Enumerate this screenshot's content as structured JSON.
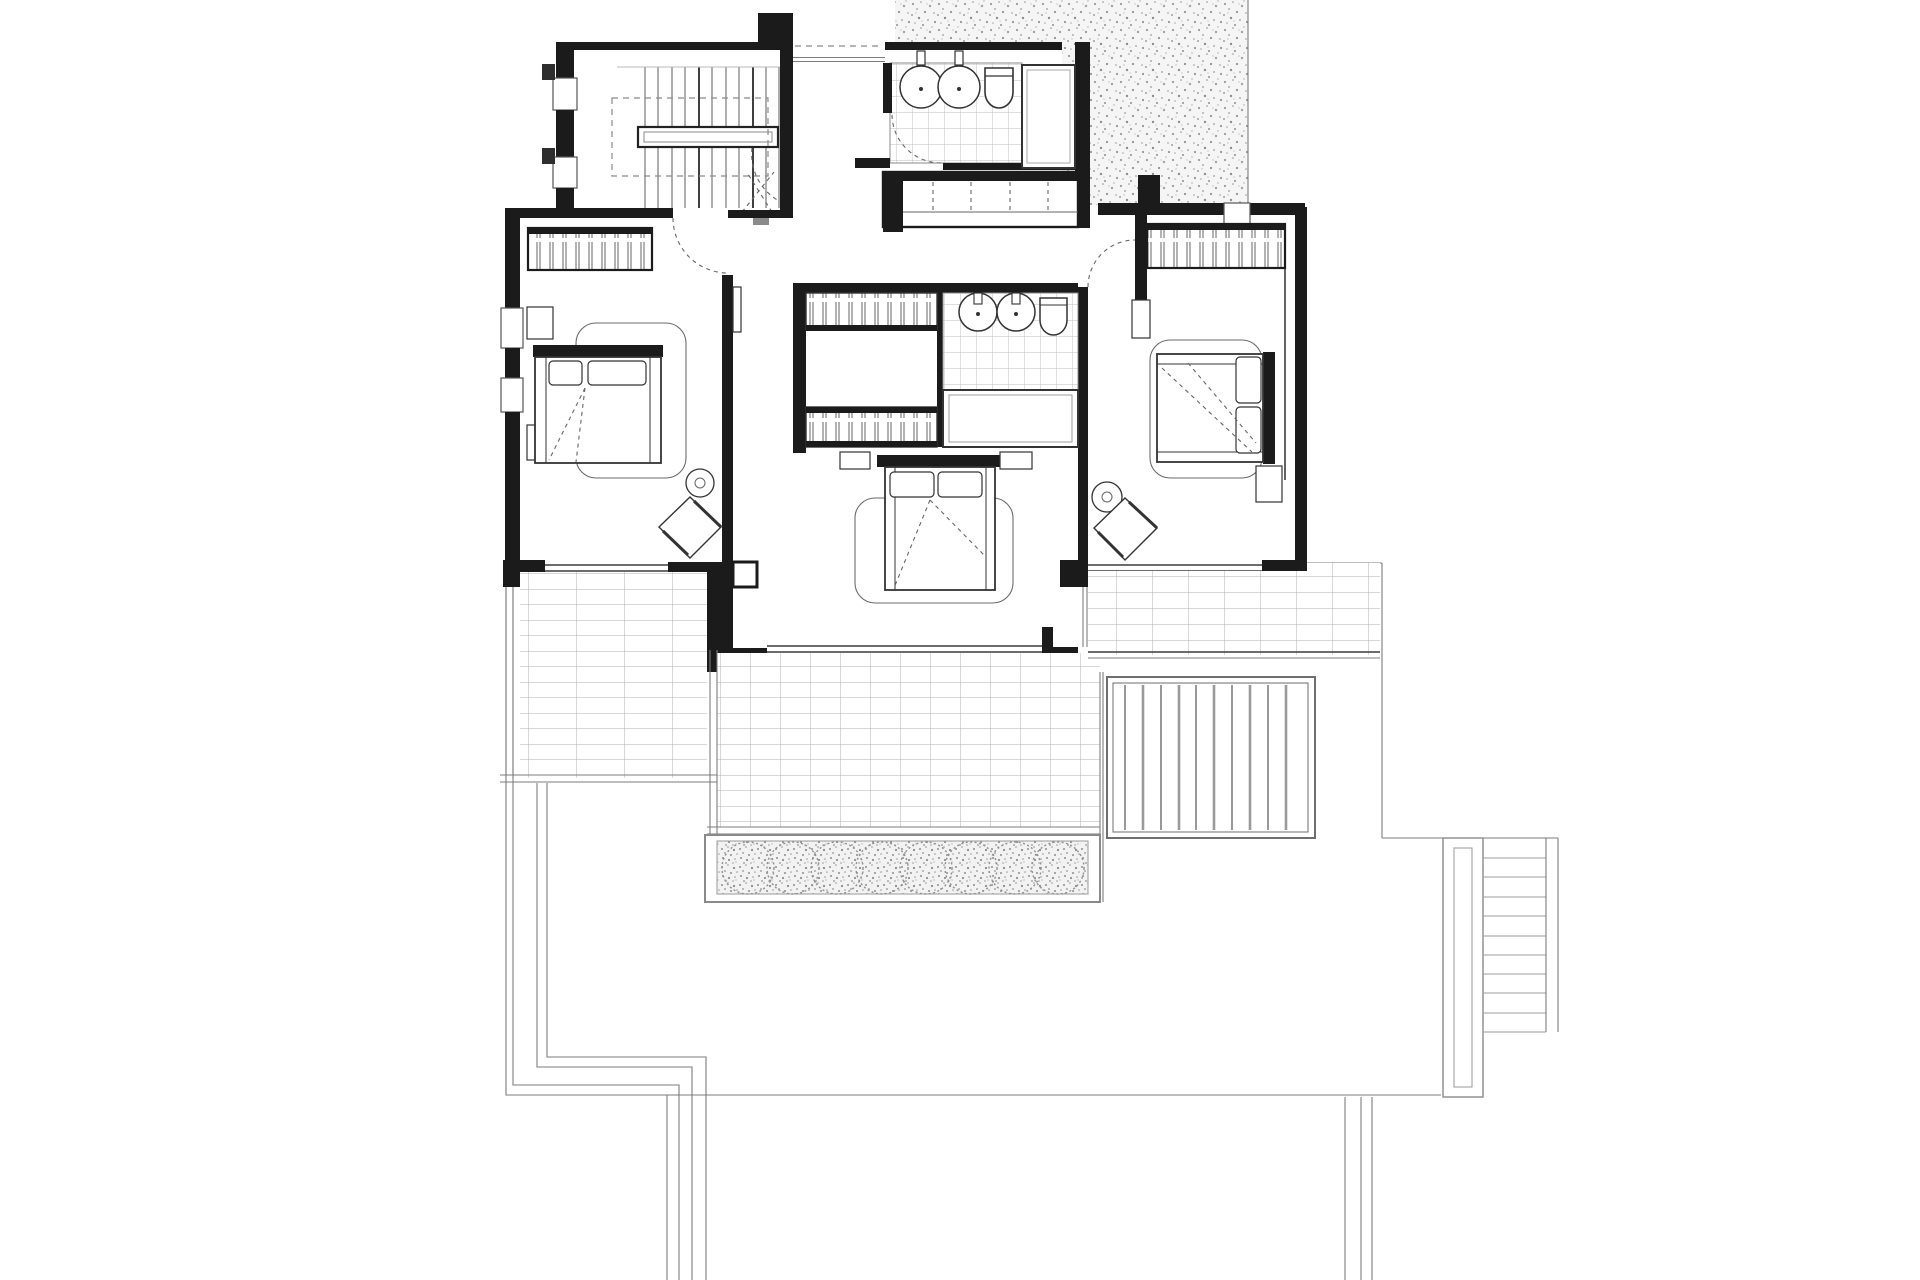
{
  "document": {
    "type": "architectural-floor-plan",
    "view": "upper floor plan, top-down CAD line drawing",
    "has_text": false,
    "background": "#ffffff"
  },
  "palette": {
    "paper": "#ffffff",
    "wall_ink": "#1b1b1b",
    "strong_line": "#3c3c3c",
    "mid_line": "#7d7d7d",
    "light_line": "#b9b9b9",
    "dashed_line": "#8a8a8a",
    "stipple": "#9a9a9a"
  },
  "rooms": [
    {
      "id": "stair-room",
      "kind": "interior staircase with handrail and open void (dashed)"
    },
    {
      "id": "bathroom-top",
      "kind": "bathroom: 2 round basins, toilet, shower, tiled floor"
    },
    {
      "id": "hall-closet",
      "kind": "open closet with dashed shelf divisions"
    },
    {
      "id": "hallway",
      "kind": "landing/hallway with three door swings"
    },
    {
      "id": "bedroom-left",
      "kind": "bedroom: wardrobe, double bed, side table, armchair"
    },
    {
      "id": "dressing",
      "kind": "dressing area with two hatched closet runs"
    },
    {
      "id": "bathroom-ensuite",
      "kind": "ensuite: 2 basins, toilet, bathtub, tiled floor"
    },
    {
      "id": "bedroom-center",
      "kind": "bedroom: double bed with two nightstands"
    },
    {
      "id": "bedroom-right",
      "kind": "bedroom: wardrobe, double bed, side table, armchair"
    },
    {
      "id": "terrace-left",
      "kind": "plank-tiled terrace"
    },
    {
      "id": "terrace-center",
      "kind": "tiled terrace"
    },
    {
      "id": "terrace-right",
      "kind": "tiled terrace"
    },
    {
      "id": "planter",
      "kind": "stippled planter bed with 8 round bushes"
    },
    {
      "id": "pergola",
      "kind": "slatted pergola / louver roof below right terrace"
    },
    {
      "id": "garden-stairs",
      "kind": "exterior stair flight at lower right"
    },
    {
      "id": "roof-stipple",
      "kind": "stippled roof/ground patch at top right"
    },
    {
      "id": "lower-level-outline",
      "kind": "thin outline of level below at bottom of sheet"
    }
  ],
  "fixture_counts": {
    "round_basins": 4,
    "toilets": 2,
    "bathtubs": 1,
    "showers": 1,
    "double_beds": 3,
    "hatched_wardrobe_runs": 4,
    "diamond_armchairs": 2,
    "round_side_tables": 2,
    "planter_bushes": 8,
    "pergola_slats": 10,
    "stair_treads_interior": 11,
    "stair_treads_garden": 10,
    "door_swings": 4
  }
}
